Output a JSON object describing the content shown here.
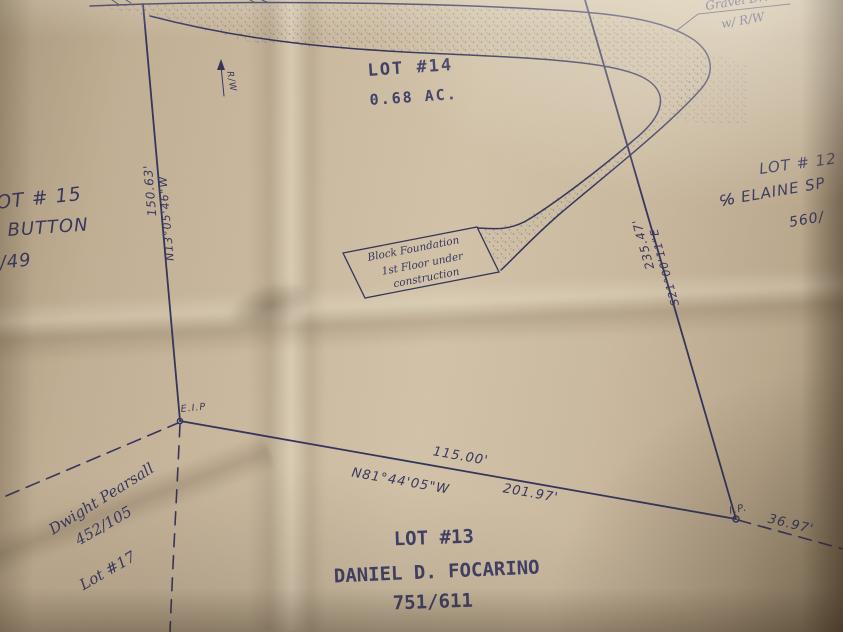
{
  "colors": {
    "paper": "#ccbba1",
    "ink": "#30305a"
  },
  "labels": {
    "lot14": {
      "title": "LOT #14",
      "area": "0.68 AC."
    },
    "lot13": {
      "title": "LOT #13",
      "owner": "DANIEL D. FOCARINO",
      "deed": "751/611"
    },
    "lot15": {
      "title": "LOT # 15",
      "owner": "BUTTON",
      "deed": "3/49"
    },
    "lot12": {
      "title": "LOT # 12",
      "owner": "℅ ELAINE SP",
      "deed": "560/"
    },
    "lot17": {
      "owner": "Dwight Pearsall",
      "deed": "452/105",
      "title": "Lot #17"
    },
    "drive": {
      "line1": "Gravel Drive",
      "line2": "w/ R/W"
    },
    "rw": "R/W",
    "foundation": {
      "line1": "Block Foundation",
      "line2": "1st Floor under",
      "line3": "construction"
    },
    "markers": {
      "eip": "E.I.P",
      "ip": "I.P."
    }
  },
  "measurements": {
    "left": {
      "distance": "150.63'",
      "bearing": "N13°05'46\"W"
    },
    "bottom": {
      "tie_distance": "115.00'",
      "bearing": "N81°44'05\"W",
      "distance": "201.97'"
    },
    "right": {
      "distance": "235.47'",
      "bearing": "S21°00'11\"E"
    },
    "corner_tie": "36.97'"
  }
}
